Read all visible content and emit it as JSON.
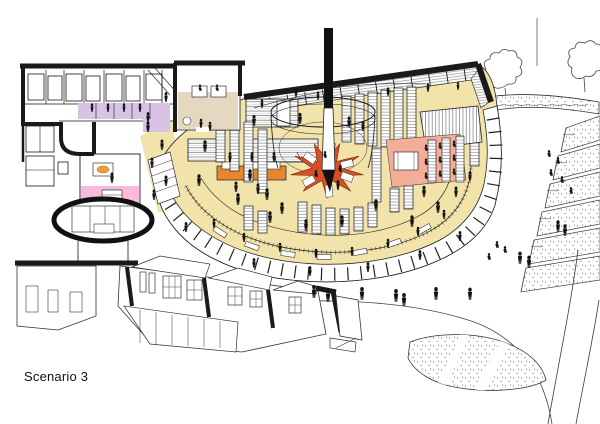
{
  "caption": {
    "label": "Scenario 3"
  },
  "page": {
    "background": "#ffffff"
  },
  "colors": {
    "paper": "#ffffff",
    "ink": "#1a1a1a",
    "floor_yellow": "#f2e3ab",
    "zone_beige": "#e4d8c1",
    "zone_purple": "#d8c3e6",
    "zone_pink": "#f9bad9",
    "zone_salmon": "#f3ad98",
    "star_red": "#d94e26",
    "counter_orange": "#e6862d",
    "accent_amber": "#e8a13f"
  }
}
